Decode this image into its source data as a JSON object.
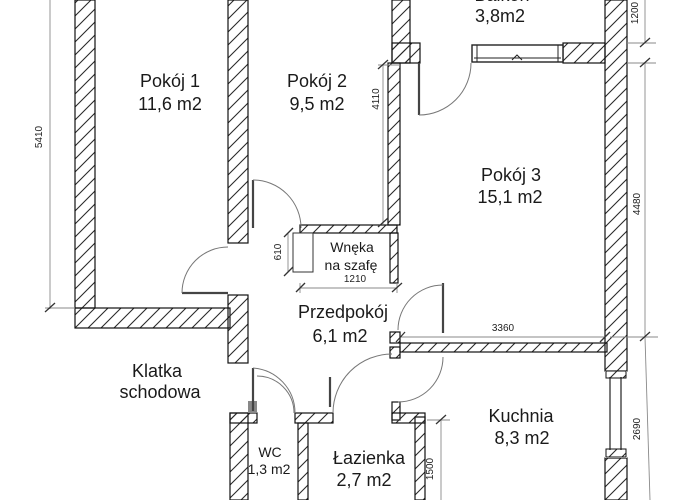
{
  "rooms": {
    "pokoj1": {
      "name": "Pokój 1",
      "area": "11,6 m2"
    },
    "pokoj2": {
      "name": "Pokój 2",
      "area": "9,5 m2"
    },
    "balkon": {
      "name": "Balkon",
      "area": "3,8m2"
    },
    "pokoj3": {
      "name": "Pokój 3",
      "area": "15,1 m2"
    },
    "wneka": {
      "name": "Wnęka",
      "name2": "na szafę"
    },
    "przedpokoj": {
      "name": "Przedpokój",
      "area": "6,1 m2"
    },
    "klatka": {
      "name": "Klatka",
      "name2": "schodowa"
    },
    "wc": {
      "name": "WC",
      "area": "1,3 m2"
    },
    "lazienka": {
      "name": "Łazienka",
      "area": "2,7 m2"
    },
    "kuchnia": {
      "name": "Kuchnia",
      "area": "8,3 m2"
    }
  },
  "dimensions_mm": {
    "left_height": "5410",
    "pokoj3_west": "4110",
    "balkon_depth": "1200",
    "pokoj3_east": "4480",
    "kuchnia_east": "2690",
    "pokoj3_south_wall": "3360",
    "lazienka_height": "1500",
    "wneka_depth": "610",
    "wneka_width": "1210"
  },
  "colors": {
    "wall_line": "#1a1a1a",
    "dimension_line": "#707070",
    "background": "#ffffff"
  }
}
